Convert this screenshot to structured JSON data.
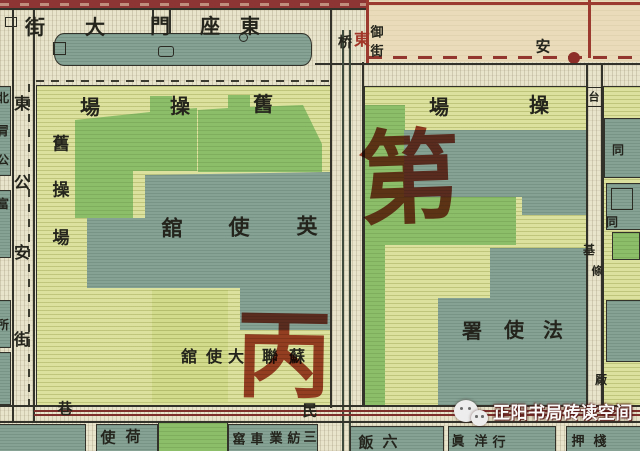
{
  "map_type": "vintage-city-map",
  "labels": {
    "top_street": [
      "街",
      "大",
      "門",
      "座",
      "東"
    ],
    "left_street": [
      "東",
      "公",
      "安",
      "街"
    ],
    "left_edge_partial": [
      "北",
      "冐",
      "公",
      "富",
      "所"
    ],
    "old_drill_ground_top": [
      "場",
      "操",
      "舊"
    ],
    "old_drill_ground_side": [
      "舊",
      "操",
      "場"
    ],
    "right_drill_ground": [
      "場",
      "操"
    ],
    "british_legation": [
      "舘",
      "使",
      "英"
    ],
    "soviet_embassy": [
      "舘",
      "使",
      "大",
      "聯",
      "蘇"
    ],
    "french_legation": [
      "署",
      "使",
      "法"
    ],
    "canal_bridge": "桥",
    "canal_red_char": "東",
    "canal_vertical": [
      "御",
      "街"
    ],
    "changan_char": "安",
    "taijichang_lane": [
      "台",
      "基",
      "條",
      "厰"
    ],
    "right_edge_hutong": [
      "同",
      "同"
    ],
    "bottom_street": [
      "巷",
      "民"
    ],
    "dutch_legation": [
      "使",
      "荷"
    ],
    "textile_block": [
      "窰",
      "車",
      "業",
      "紡",
      "三"
    ],
    "hotel_block": [
      "飯",
      "六"
    ],
    "firm_block": [
      "眞",
      "洋",
      "行"
    ],
    "pawn_block": [
      "押",
      "棧"
    ]
  },
  "annotations": {
    "red_stamp_right": "第",
    "red_stamp_center": "丙"
  },
  "watermark": {
    "text": "正阳书局砖读空间",
    "icon": "wechat-icon"
  },
  "colors": {
    "block_light": "#dce29e",
    "park_green": "#8cbd68",
    "building_teal": "#85a295",
    "street": "#e8e4cb",
    "cream_block": "#eadcba",
    "road_band_red": "#8d3434",
    "tram_red": "#7d2f2b",
    "annotation_red": "#9e2a18",
    "line_dark": "#32322a"
  }
}
